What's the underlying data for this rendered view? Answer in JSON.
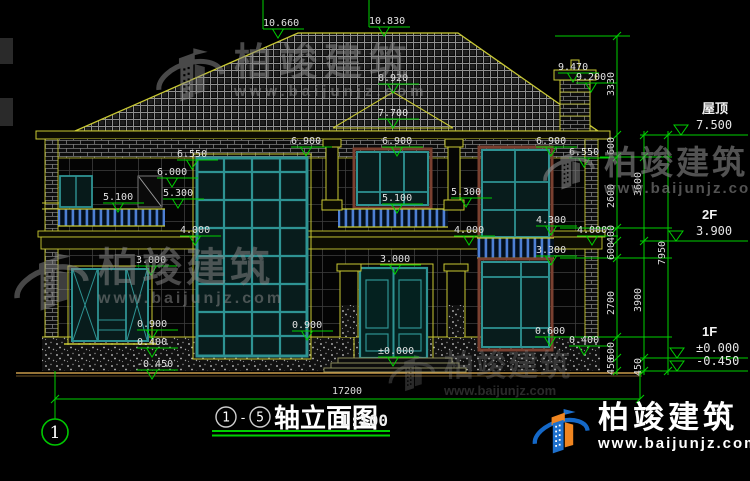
{
  "brand": {
    "name": "柏竣建筑",
    "url": "www.baijunjz.com"
  },
  "title_block": {
    "axis_start": "1",
    "axis_end": "5",
    "separator": "-",
    "title": "轴立面图",
    "scale": "1:100"
  },
  "axis_bubble": {
    "label": "1"
  },
  "levels": [
    {
      "name": "屋顶",
      "value": "7.500",
      "y": 135,
      "apex_x": 681
    },
    {
      "name": "2F",
      "value": "3.900",
      "y": 241,
      "apex_x": 676
    },
    {
      "name": "1F",
      "value": "±0.000",
      "y": 358,
      "apex_x": 677
    },
    {
      "name": "",
      "value": "-0.450",
      "y": 371,
      "apex_x": 677
    }
  ],
  "elevation_markers": [
    {
      "label": "10.660",
      "x": 278,
      "y": 38
    },
    {
      "label": "10.830",
      "x": 384,
      "y": 36
    },
    {
      "label": "9.470",
      "x": 573,
      "y": 82
    },
    {
      "label": "9.200",
      "x": 591,
      "y": 92
    },
    {
      "label": "8.920",
      "x": 393,
      "y": 93
    },
    {
      "label": "7.700",
      "x": 393,
      "y": 128
    },
    {
      "label": "6.900",
      "x": 306,
      "y": 156
    },
    {
      "label": "6.900",
      "x": 397,
      "y": 156
    },
    {
      "label": "6.900",
      "x": 551,
      "y": 156
    },
    {
      "label": "6.550",
      "x": 192,
      "y": 169
    },
    {
      "label": "6.550",
      "x": 584,
      "y": 167
    },
    {
      "label": "6.000",
      "x": 172,
      "y": 187
    },
    {
      "label": "5.300",
      "x": 178,
      "y": 208
    },
    {
      "label": "5.300",
      "x": 466,
      "y": 207
    },
    {
      "label": "5.100",
      "x": 118,
      "y": 212
    },
    {
      "label": "5.100",
      "x": 397,
      "y": 213
    },
    {
      "label": "4.300",
      "x": 551,
      "y": 235
    },
    {
      "label": "4.000",
      "x": 195,
      "y": 245
    },
    {
      "label": "4.000",
      "x": 469,
      "y": 245
    },
    {
      "label": "4.000",
      "x": 592,
      "y": 245
    },
    {
      "label": "3.300",
      "x": 551,
      "y": 265
    },
    {
      "label": "3.000",
      "x": 151,
      "y": 275
    },
    {
      "label": "3.000",
      "x": 395,
      "y": 274
    },
    {
      "label": "0.900",
      "x": 152,
      "y": 339
    },
    {
      "label": "0.900",
      "x": 307,
      "y": 340
    },
    {
      "label": "0.600",
      "x": 550,
      "y": 346
    },
    {
      "label": "0.400",
      "x": 152,
      "y": 357
    },
    {
      "label": "0.400",
      "x": 584,
      "y": 355
    },
    {
      "label": "±0.000",
      "x": 393,
      "y": 366
    },
    {
      "label": "-0.450",
      "x": 152,
      "y": 379
    }
  ],
  "dimensions": [
    {
      "text": "3330",
      "x": 614,
      "y": 84,
      "rot": true
    },
    {
      "text": "600",
      "x": 614,
      "y": 146,
      "rot": true
    },
    {
      "text": "2600",
      "x": 614,
      "y": 196,
      "rot": true
    },
    {
      "text": "3600",
      "x": 641,
      "y": 184,
      "rot": true
    },
    {
      "text": "400",
      "x": 614,
      "y": 234,
      "rot": true
    },
    {
      "text": "600",
      "x": 614,
      "y": 251,
      "rot": true
    },
    {
      "text": "2700",
      "x": 614,
      "y": 303,
      "rot": true
    },
    {
      "text": "3900",
      "x": 641,
      "y": 300,
      "rot": true
    },
    {
      "text": "7950",
      "x": 665,
      "y": 253,
      "rot": true
    },
    {
      "text": "600",
      "x": 614,
      "y": 351,
      "rot": true
    },
    {
      "text": "450",
      "x": 614,
      "y": 366,
      "rot": true
    },
    {
      "text": "450",
      "x": 641,
      "y": 367,
      "rot": true
    },
    {
      "text": "17200",
      "x": 347,
      "y": 394,
      "rot": false
    }
  ],
  "colors": {
    "background": "#000000",
    "line_yellow": "#c9c932",
    "line_green": "#00cf00",
    "frame_teal": "#2e9393",
    "railing_blue": "#4d7fd4",
    "surround_brown": "#7a4030",
    "ground_tan": "#c89a4a",
    "brand_blue": "#1e70cc",
    "brand_orange": "#f08520",
    "dim_text": "#e2e2e2"
  }
}
